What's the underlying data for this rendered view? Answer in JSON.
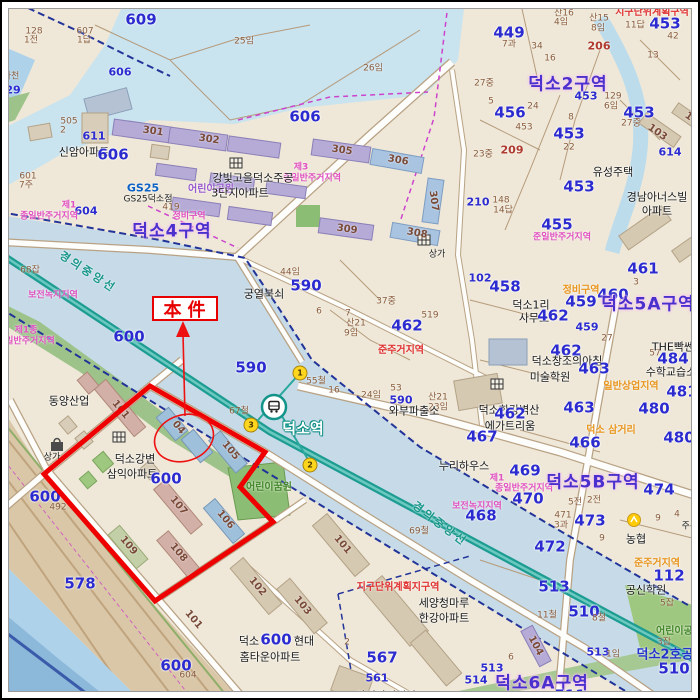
{
  "annotation": {
    "label": "本件"
  },
  "station": {
    "name": "덕소역",
    "exit_numbers": [
      "1",
      "2",
      "3"
    ]
  },
  "rail_line": "경의중앙선",
  "subject": {
    "complex_name": "덕소강변 삼익아파트",
    "parcel_number": "600",
    "circled_building": "04"
  },
  "districts": [
    "덕소2구역",
    "덕소4구역",
    "덕소5A구역",
    "덕소5B구역",
    "덕소6A구역"
  ],
  "colors": {
    "subject_red": "#e80000",
    "railway_teal": "#1d9c92",
    "parcel_number_blue": "#2b2bd0",
    "district_purple": "#4a30cc",
    "zoning_pink": "#e050c0",
    "water_blue": "#c9e3ef"
  },
  "exits": [
    {
      "n": "1",
      "x": 300,
      "y": 373
    },
    {
      "n": "3",
      "x": 251,
      "y": 425
    },
    {
      "n": "2",
      "x": 310,
      "y": 465
    }
  ],
  "labels": [
    {
      "t": "609",
      "x": 141,
      "y": 20,
      "c": "num-lg"
    },
    {
      "t": "607",
      "x": 85,
      "y": 32,
      "c": "num-sm"
    },
    {
      "t": "1답",
      "x": 84,
      "y": 41,
      "c": "num-sm"
    },
    {
      "t": "128",
      "x": 34,
      "y": 32,
      "c": "num-sm"
    },
    {
      "t": "1전",
      "x": 31,
      "y": 41,
      "c": "num-sm"
    },
    {
      "t": "606",
      "x": 120,
      "y": 72,
      "c": "num-md"
    },
    {
      "t": "하천",
      "x": 11,
      "y": 77,
      "c": "num-sm"
    },
    {
      "t": "29",
      "x": 13,
      "y": 90,
      "c": "num-md"
    },
    {
      "t": "505",
      "x": 69,
      "y": 122,
      "c": "num-sm"
    },
    {
      "t": "2",
      "x": 63,
      "y": 131,
      "c": "num-sm"
    },
    {
      "t": "611",
      "x": 94,
      "y": 136,
      "c": "num-md"
    },
    {
      "t": "신암아파트",
      "x": 84,
      "y": 152,
      "c": "place"
    },
    {
      "t": "606",
      "x": 113,
      "y": 155,
      "c": "num-lg"
    },
    {
      "t": "601",
      "x": 28,
      "y": 177,
      "c": "num-sm"
    },
    {
      "t": "7주",
      "x": 26,
      "y": 186,
      "c": "num-sm"
    },
    {
      "t": "GS25",
      "x": 143,
      "y": 188,
      "c": "gs25"
    },
    {
      "t": "GS25덕소점",
      "x": 148,
      "y": 200,
      "c": "place-sm"
    },
    {
      "t": "419",
      "x": 171,
      "y": 208,
      "c": "num-sm"
    },
    {
      "t": "제1",
      "x": 69,
      "y": 206,
      "c": "zone-pink"
    },
    {
      "t": "604",
      "x": 86,
      "y": 211,
      "c": "num-md"
    },
    {
      "t": "종일반주거지역",
      "x": 49,
      "y": 217,
      "c": "zone-pink"
    },
    {
      "t": "정비구역",
      "x": 189,
      "y": 217,
      "c": "zone-pink"
    },
    {
      "t": "덕소4구역",
      "x": 172,
      "y": 232,
      "c": "zone-big"
    },
    {
      "t": "25임",
      "x": 244,
      "y": 42,
      "c": "num-sm"
    },
    {
      "t": "26임",
      "x": 373,
      "y": 69,
      "c": "num-sm"
    },
    {
      "t": "606",
      "x": 305,
      "y": 117,
      "c": "num-lg"
    },
    {
      "t": "301",
      "x": 153,
      "y": 132,
      "c": "bldg",
      "r": 8
    },
    {
      "t": "302",
      "x": 209,
      "y": 140,
      "c": "bldg",
      "r": 8
    },
    {
      "t": "305",
      "x": 342,
      "y": 151,
      "c": "bldg",
      "r": 8
    },
    {
      "t": "306",
      "x": 398,
      "y": 161,
      "c": "bldg",
      "r": 10
    },
    {
      "t": "제3",
      "x": 301,
      "y": 168,
      "c": "zone-pink"
    },
    {
      "t": "종일반주거지역",
      "x": 312,
      "y": 179,
      "c": "zone-pink"
    },
    {
      "t": "강빛고을덕소주공",
      "x": 253,
      "y": 178,
      "c": "place"
    },
    {
      "t": "어린이공원",
      "x": 211,
      "y": 190,
      "c": "zone-purple"
    },
    {
      "t": "3단지아파트",
      "x": 240,
      "y": 193,
      "c": "place"
    },
    {
      "t": "307",
      "x": 433,
      "y": 201,
      "c": "bldg",
      "r": 82
    },
    {
      "t": "309",
      "x": 347,
      "y": 230,
      "c": "bldg",
      "r": 8
    },
    {
      "t": "308",
      "x": 417,
      "y": 234,
      "c": "bldg",
      "r": 10
    },
    {
      "t": "상가",
      "x": 437,
      "y": 255,
      "c": "place-sm"
    },
    {
      "t": "44임",
      "x": 290,
      "y": 273,
      "c": "num-sm"
    },
    {
      "t": "590",
      "x": 306,
      "y": 286,
      "c": "num-lg"
    },
    {
      "t": "궁열북쇠",
      "x": 264,
      "y": 294,
      "c": "place"
    },
    {
      "t": "37중",
      "x": 386,
      "y": 302,
      "c": "num-sm"
    },
    {
      "t": "6",
      "x": 319,
      "y": 312,
      "c": "num-sm"
    },
    {
      "t": "7",
      "x": 348,
      "y": 314,
      "c": "num-sm"
    },
    {
      "t": "산21",
      "x": 356,
      "y": 324,
      "c": "num-sm"
    },
    {
      "t": "9임",
      "x": 351,
      "y": 334,
      "c": "num-sm"
    },
    {
      "t": "519",
      "x": 430,
      "y": 316,
      "c": "num-sm"
    },
    {
      "t": "462",
      "x": 407,
      "y": 326,
      "c": "num-lg"
    },
    {
      "t": "준주거지역",
      "x": 401,
      "y": 351,
      "c": "zone-red"
    },
    {
      "t": "590",
      "x": 251,
      "y": 368,
      "c": "num-lg"
    },
    {
      "t": "55철",
      "x": 316,
      "y": 382,
      "c": "num-sm"
    },
    {
      "t": "16",
      "x": 334,
      "y": 391,
      "c": "num-sm"
    },
    {
      "t": "24임",
      "x": 371,
      "y": 396,
      "c": "num-sm"
    },
    {
      "t": "53",
      "x": 396,
      "y": 389,
      "c": "num-sm"
    },
    {
      "t": "590",
      "x": 401,
      "y": 400,
      "c": "num-md"
    },
    {
      "t": "산21",
      "x": 438,
      "y": 398,
      "c": "num-sm"
    },
    {
      "t": "23임",
      "x": 438,
      "y": 408,
      "c": "num-sm"
    },
    {
      "t": "와부파출소",
      "x": 414,
      "y": 411,
      "c": "place"
    },
    {
      "t": "67철",
      "x": 239,
      "y": 412,
      "c": "num-sm"
    },
    {
      "t": "69철",
      "x": 419,
      "y": 532,
      "c": "num-sm"
    },
    {
      "t": "덕소역",
      "x": 303,
      "y": 429,
      "c": "station-name"
    },
    {
      "t": "449",
      "x": 509,
      "y": 33,
      "c": "num-lg"
    },
    {
      "t": "7과",
      "x": 509,
      "y": 45,
      "c": "num-sm"
    },
    {
      "t": "산16",
      "x": 564,
      "y": 14,
      "c": "num-sm"
    },
    {
      "t": "4임",
      "x": 561,
      "y": 23,
      "c": "num-sm"
    },
    {
      "t": "산15",
      "x": 599,
      "y": 19,
      "c": "num-sm"
    },
    {
      "t": "8임",
      "x": 598,
      "y": 29,
      "c": "num-sm"
    },
    {
      "t": "지구단위계획구역",
      "x": 652,
      "y": 13,
      "c": "zone-red"
    },
    {
      "t": "11답",
      "x": 635,
      "y": 26,
      "c": "num-sm"
    },
    {
      "t": "453",
      "x": 665,
      "y": 24,
      "c": "num-lg"
    },
    {
      "t": "42",
      "x": 673,
      "y": 37,
      "c": "num-sm"
    },
    {
      "t": "206",
      "x": 599,
      "y": 46,
      "c": "num-red"
    },
    {
      "t": "34",
      "x": 537,
      "y": 47,
      "c": "num-sm"
    },
    {
      "t": "16",
      "x": 550,
      "y": 59,
      "c": "num-sm"
    },
    {
      "t": "13",
      "x": 653,
      "y": 56,
      "c": "num-sm"
    },
    {
      "t": "덕소2구역",
      "x": 568,
      "y": 85,
      "c": "zone-big"
    },
    {
      "t": "453",
      "x": 586,
      "y": 96,
      "c": "num-md"
    },
    {
      "t": "27중",
      "x": 484,
      "y": 84,
      "c": "num-sm"
    },
    {
      "t": "5",
      "x": 491,
      "y": 102,
      "c": "num-sm"
    },
    {
      "t": "456",
      "x": 510,
      "y": 113,
      "c": "num-lg"
    },
    {
      "t": "24",
      "x": 533,
      "y": 107,
      "c": "num-sm"
    },
    {
      "t": "129",
      "x": 613,
      "y": 97,
      "c": "num-sm"
    },
    {
      "t": "6임",
      "x": 611,
      "y": 107,
      "c": "num-sm"
    },
    {
      "t": "453",
      "x": 639,
      "y": 113,
      "c": "num-lg"
    },
    {
      "t": "27중",
      "x": 631,
      "y": 124,
      "c": "num-sm"
    },
    {
      "t": "453",
      "x": 524,
      "y": 128,
      "c": "num-sm"
    },
    {
      "t": "8",
      "x": 571,
      "y": 118,
      "c": "num-sm"
    },
    {
      "t": "453",
      "x": 569,
      "y": 134,
      "c": "num-lg"
    },
    {
      "t": "22",
      "x": 569,
      "y": 148,
      "c": "num-sm"
    },
    {
      "t": "209",
      "x": 512,
      "y": 150,
      "c": "num-red"
    },
    {
      "t": "23중",
      "x": 483,
      "y": 155,
      "c": "num-sm"
    },
    {
      "t": "102",
      "x": 694,
      "y": 121,
      "c": "bldg",
      "r": 35
    },
    {
      "t": "103",
      "x": 657,
      "y": 133,
      "c": "bldg",
      "r": 35
    },
    {
      "t": "614",
      "x": 670,
      "y": 152,
      "c": "num-md"
    },
    {
      "t": "유성주택",
      "x": 613,
      "y": 172,
      "c": "place"
    },
    {
      "t": "453",
      "x": 579,
      "y": 187,
      "c": "num-lg"
    },
    {
      "t": "경남아너스빌",
      "x": 657,
      "y": 197,
      "c": "place"
    },
    {
      "t": "아파트",
      "x": 657,
      "y": 211,
      "c": "place"
    },
    {
      "t": "455",
      "x": 557,
      "y": 225,
      "c": "num-lg"
    },
    {
      "t": "210",
      "x": 478,
      "y": 202,
      "c": "num-md"
    },
    {
      "t": "148",
      "x": 501,
      "y": 201,
      "c": "num-sm"
    },
    {
      "t": "14답",
      "x": 503,
      "y": 211,
      "c": "num-sm"
    },
    {
      "t": "준일반주거지역",
      "x": 562,
      "y": 238,
      "c": "zone-pink"
    },
    {
      "t": "102",
      "x": 480,
      "y": 278,
      "c": "num-md"
    },
    {
      "t": "458",
      "x": 505,
      "y": 287,
      "c": "num-lg"
    },
    {
      "t": "461",
      "x": 643,
      "y": 269,
      "c": "num-lg"
    },
    {
      "t": "3",
      "x": 636,
      "y": 283,
      "c": "num-sm"
    },
    {
      "t": "덕소1리",
      "x": 531,
      "y": 305,
      "c": "place"
    },
    {
      "t": "사무소",
      "x": 534,
      "y": 318,
      "c": "place"
    },
    {
      "t": "정비구역",
      "x": 581,
      "y": 291,
      "c": "zone-orange"
    },
    {
      "t": "459",
      "x": 581,
      "y": 302,
      "c": "num-lg"
    },
    {
      "t": "460",
      "x": 613,
      "y": 295,
      "c": "num-lg"
    },
    {
      "t": "덕소5A구역",
      "x": 648,
      "y": 305,
      "c": "zone-big"
    },
    {
      "t": "462",
      "x": 553,
      "y": 316,
      "c": "num-lg"
    },
    {
      "t": "459",
      "x": 587,
      "y": 327,
      "c": "num-md"
    },
    {
      "t": "27",
      "x": 607,
      "y": 339,
      "c": "num-sm"
    },
    {
      "t": "462",
      "x": 566,
      "y": 351,
      "c": "num-lg"
    },
    {
      "t": "덕소창조의아침",
      "x": 567,
      "y": 361,
      "c": "place"
    },
    {
      "t": "미술학원",
      "x": 550,
      "y": 377,
      "c": "place"
    },
    {
      "t": "463",
      "x": 594,
      "y": 369,
      "c": "num-lg"
    },
    {
      "t": "57",
      "x": 655,
      "y": 354,
      "c": "num-sm"
    },
    {
      "t": "THE빡쎈",
      "x": 673,
      "y": 347,
      "c": "place"
    },
    {
      "t": "484",
      "x": 673,
      "y": 359,
      "c": "num-lg"
    },
    {
      "t": "수학교습소",
      "x": 671,
      "y": 372,
      "c": "place"
    },
    {
      "t": "일반상업지역",
      "x": 631,
      "y": 387,
      "c": "zone-orange"
    },
    {
      "t": "481",
      "x": 682,
      "y": 392,
      "c": "num-lg"
    },
    {
      "t": "463",
      "x": 579,
      "y": 408,
      "c": "num-lg"
    },
    {
      "t": "덕소한강벽산",
      "x": 509,
      "y": 410,
      "c": "place"
    },
    {
      "t": "462",
      "x": 510,
      "y": 414,
      "c": "num-lg"
    },
    {
      "t": "에가트리움",
      "x": 510,
      "y": 426,
      "c": "place"
    },
    {
      "t": "467",
      "x": 482,
      "y": 437,
      "c": "num-lg"
    },
    {
      "t": "466",
      "x": 585,
      "y": 443,
      "c": "num-lg"
    },
    {
      "t": "덕소 삼거리",
      "x": 611,
      "y": 431,
      "c": "zone-orange"
    },
    {
      "t": "480",
      "x": 654,
      "y": 409,
      "c": "num-lg"
    },
    {
      "t": "480",
      "x": 679,
      "y": 438,
      "c": "num-lg"
    },
    {
      "t": "누리하우스",
      "x": 464,
      "y": 466,
      "c": "place"
    },
    {
      "t": "469",
      "x": 525,
      "y": 471,
      "c": "num-lg"
    },
    {
      "t": "제1",
      "x": 497,
      "y": 479,
      "c": "zone-pink"
    },
    {
      "t": "종일반주거지역",
      "x": 524,
      "y": 489,
      "c": "zone-pink"
    },
    {
      "t": "470",
      "x": 528,
      "y": 499,
      "c": "num-lg"
    },
    {
      "t": "보전녹지지역",
      "x": 477,
      "y": 507,
      "c": "zone-pink"
    },
    {
      "t": "468",
      "x": 481,
      "y": 516,
      "c": "num-lg"
    },
    {
      "t": "덕소5B구역",
      "x": 593,
      "y": 483,
      "c": "zone-big"
    },
    {
      "t": "474",
      "x": 659,
      "y": 490,
      "c": "num-lg"
    },
    {
      "t": "5전",
      "x": 575,
      "y": 503,
      "c": "num-sm"
    },
    {
      "t": "2전",
      "x": 594,
      "y": 501,
      "c": "num-sm"
    },
    {
      "t": "471",
      "x": 563,
      "y": 516,
      "c": "num-sm"
    },
    {
      "t": "3과",
      "x": 561,
      "y": 526,
      "c": "num-sm"
    },
    {
      "t": "473",
      "x": 590,
      "y": 521,
      "c": "num-lg"
    },
    {
      "t": "9",
      "x": 602,
      "y": 539,
      "c": "num-sm"
    },
    {
      "t": "4",
      "x": 677,
      "y": 515,
      "c": "num-sm"
    },
    {
      "t": "9",
      "x": 658,
      "y": 519,
      "c": "num-sm"
    },
    {
      "t": "농협",
      "x": 636,
      "y": 539,
      "c": "place"
    },
    {
      "t": "주유소",
      "x": 694,
      "y": 527,
      "c": "place-sm"
    },
    {
      "t": "472",
      "x": 550,
      "y": 547,
      "c": "num-lg"
    },
    {
      "t": "준주거지역",
      "x": 657,
      "y": 564,
      "c": "zone-orange"
    },
    {
      "t": "112",
      "x": 669,
      "y": 576,
      "c": "num-lg"
    },
    {
      "t": "공신학원",
      "x": 646,
      "y": 590,
      "c": "place"
    },
    {
      "t": "513",
      "x": 554,
      "y": 587,
      "c": "num-lg"
    },
    {
      "t": "5잡",
      "x": 667,
      "y": 604,
      "c": "num-sm"
    },
    {
      "t": "510",
      "x": 584,
      "y": 612,
      "c": "num-lg"
    },
    {
      "t": "11철",
      "x": 547,
      "y": 616,
      "c": "num-sm"
    },
    {
      "t": "8철",
      "x": 599,
      "y": 619,
      "c": "num-sm"
    },
    {
      "t": "104",
      "x": 535,
      "y": 646,
      "c": "bldg",
      "r": 62
    },
    {
      "t": "513",
      "x": 598,
      "y": 652,
      "c": "num-md"
    },
    {
      "t": "1임",
      "x": 613,
      "y": 655,
      "c": "num-sm"
    },
    {
      "t": "어린이공원",
      "x": 679,
      "y": 632,
      "c": "zone-green"
    },
    {
      "t": "3잡",
      "x": 664,
      "y": 643,
      "c": "num-sm"
    },
    {
      "t": "덕소2호공",
      "x": 665,
      "y": 655,
      "c": "blue-place"
    },
    {
      "t": "510",
      "x": 674,
      "y": 669,
      "c": "num-lg"
    },
    {
      "t": "513",
      "x": 492,
      "y": 668,
      "c": "num-md"
    },
    {
      "t": "514",
      "x": 476,
      "y": 680,
      "c": "num-md"
    },
    {
      "t": "6",
      "x": 511,
      "y": 658,
      "c": "num-sm"
    },
    {
      "t": "덕소6A구역",
      "x": 542,
      "y": 684,
      "c": "zone-big"
    },
    {
      "t": "511",
      "x": 570,
      "y": 696,
      "c": "num-lg"
    },
    {
      "t": "어린이꿈원",
      "x": 269,
      "y": 488,
      "c": "zone-green"
    },
    {
      "t": "101",
      "x": 342,
      "y": 545,
      "c": "bldg",
      "r": 50
    },
    {
      "t": "경의중앙선",
      "x": 440,
      "y": 524,
      "c": "teal-label",
      "r": 37
    },
    {
      "t": "경의중앙선",
      "x": 88,
      "y": 272,
      "c": "teal-label",
      "r": 33
    },
    {
      "t": "지구단위계획지구역",
      "x": 398,
      "y": 588,
      "c": "zone-red"
    },
    {
      "t": "세양청마루",
      "x": 444,
      "y": 603,
      "c": "place"
    },
    {
      "t": "한강아파트",
      "x": 444,
      "y": 618,
      "c": "place"
    },
    {
      "t": "102",
      "x": 257,
      "y": 587,
      "c": "bldg",
      "r": 50
    },
    {
      "t": "103",
      "x": 302,
      "y": 606,
      "c": "bldg",
      "r": 50
    },
    {
      "t": "덕소",
      "x": 249,
      "y": 641,
      "c": "place"
    },
    {
      "t": "600",
      "x": 276,
      "y": 640,
      "c": "num-lg"
    },
    {
      "t": "현대",
      "x": 304,
      "y": 641,
      "c": "place"
    },
    {
      "t": "홈타운아파트",
      "x": 270,
      "y": 657,
      "c": "place"
    },
    {
      "t": "2",
      "x": 347,
      "y": 643,
      "c": "num-sm"
    },
    {
      "t": "567",
      "x": 382,
      "y": 658,
      "c": "num-lg"
    },
    {
      "t": "561",
      "x": 377,
      "y": 678,
      "c": "num-md"
    },
    {
      "t": "아성강변빌라",
      "x": 386,
      "y": 696,
      "c": "place"
    },
    {
      "t": "68잡",
      "x": 30,
      "y": 271,
      "c": "num-sm"
    },
    {
      "t": "보전녹지지역",
      "x": 53,
      "y": 296,
      "c": "zone-pink"
    },
    {
      "t": "제1종",
      "x": 26,
      "y": 331,
      "c": "zone-pink"
    },
    {
      "t": "일반주거지역",
      "x": 30,
      "y": 342,
      "c": "zone-pink"
    },
    {
      "t": "600",
      "x": 129,
      "y": 337,
      "c": "num-lg"
    },
    {
      "t": "동양산업",
      "x": 69,
      "y": 401,
      "c": "place"
    },
    {
      "t": "101",
      "x": 120,
      "y": 410,
      "c": "bldg",
      "r": 50
    },
    {
      "t": "04",
      "x": 178,
      "y": 428,
      "c": "bldg",
      "r": 50
    },
    {
      "t": "105",
      "x": 230,
      "y": 451,
      "c": "bldg",
      "r": 50
    },
    {
      "t": "덕소강변",
      "x": 135,
      "y": 459,
      "c": "place"
    },
    {
      "t": "삼익아파트",
      "x": 132,
      "y": 474,
      "c": "place"
    },
    {
      "t": "600",
      "x": 166,
      "y": 479,
      "c": "num-lg"
    },
    {
      "t": "107",
      "x": 178,
      "y": 506,
      "c": "bldg",
      "r": 50
    },
    {
      "t": "106",
      "x": 225,
      "y": 520,
      "c": "bldg",
      "r": 50
    },
    {
      "t": "109",
      "x": 128,
      "y": 546,
      "c": "bldg",
      "r": 50
    },
    {
      "t": "108",
      "x": 178,
      "y": 553,
      "c": "bldg",
      "r": 50
    },
    {
      "t": "상가",
      "x": 52,
      "y": 458,
      "c": "place-sm"
    },
    {
      "t": "578",
      "x": 80,
      "y": 584,
      "c": "num-lg"
    },
    {
      "t": "600",
      "x": 45,
      "y": 497,
      "c": "num-lg"
    },
    {
      "t": "492",
      "x": 58,
      "y": 508,
      "c": "num-sm"
    },
    {
      "t": "101",
      "x": 193,
      "y": 620,
      "c": "bldg",
      "r": 50
    },
    {
      "t": "600",
      "x": 176,
      "y": 666,
      "c": "num-lg"
    },
    {
      "t": "604",
      "x": 188,
      "y": 676,
      "c": "num-sm"
    }
  ]
}
